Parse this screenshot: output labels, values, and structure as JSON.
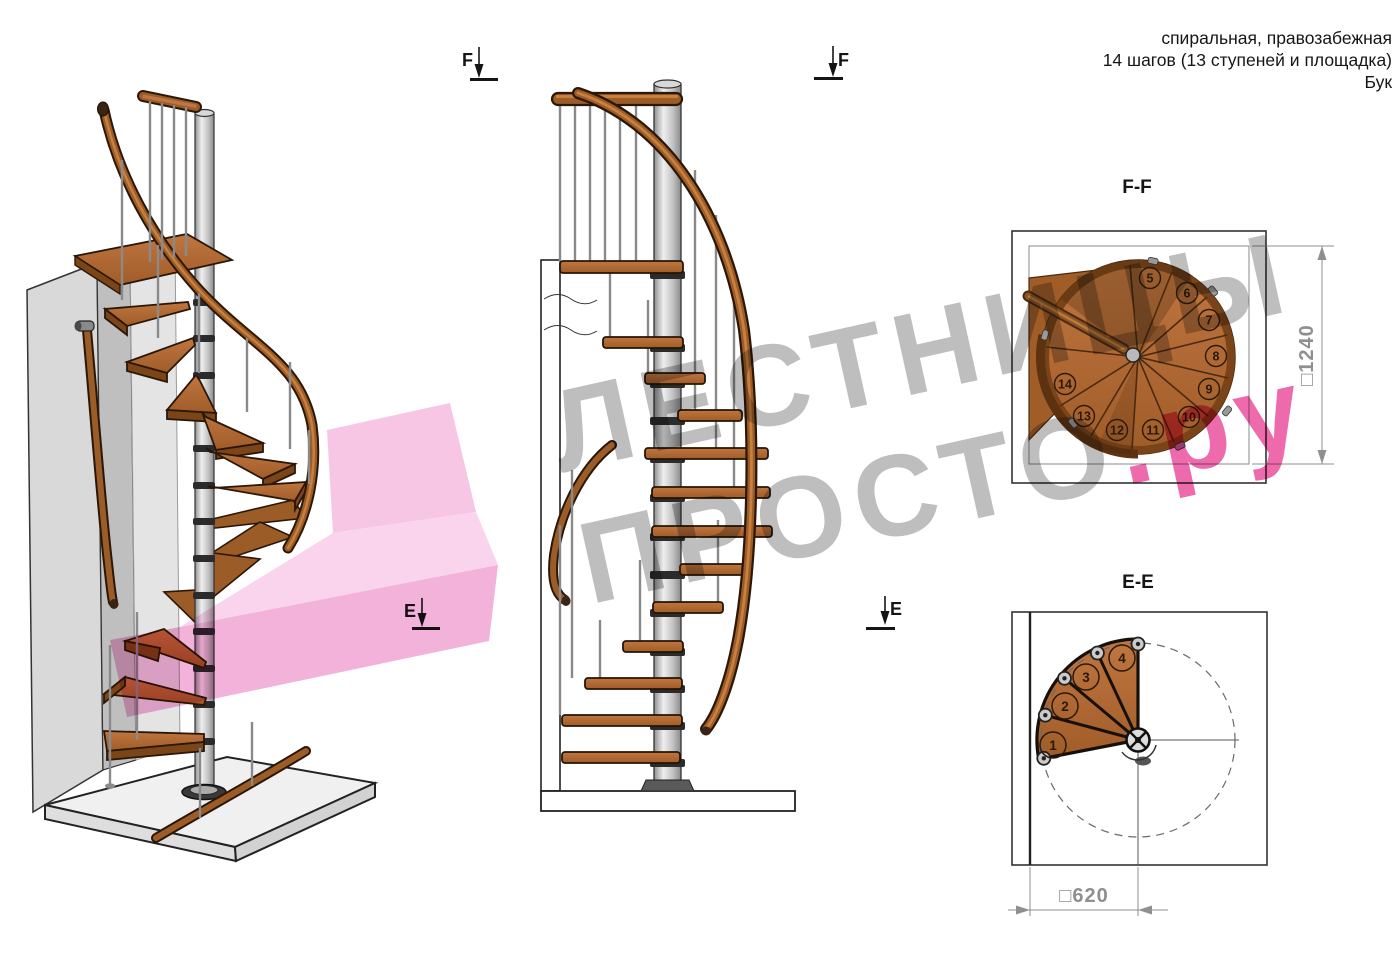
{
  "title": {
    "line1": "спиральная, правозабежная",
    "line2": "14 шагов (13 ступеней и площадка)",
    "line3": "Бук"
  },
  "watermark": {
    "line1": "ЛЕСТНИЦЫ",
    "line2_gray": "ПРОСТО",
    "line2_pink": ".ру"
  },
  "markers": {
    "f": "F",
    "e": "E"
  },
  "views": {
    "ff": {
      "label": "F-F",
      "dimension": "□1240",
      "steps": [
        "5",
        "6",
        "7",
        "8",
        "9",
        "10",
        "11",
        "12",
        "13",
        "14"
      ]
    },
    "ee": {
      "label": "E-E",
      "dimension": "□620",
      "steps": [
        "1",
        "2",
        "3",
        "4"
      ]
    }
  },
  "colors": {
    "wood": "#b06a33",
    "wood_dark": "#7c4517",
    "pole_gray": "#c9c9c9",
    "watermark_gray": "#b9b9b9",
    "watermark_pink": "#ec5ea6",
    "pink_arrow": "#f1a4d3",
    "dimension_gray": "#8f8f8f"
  }
}
